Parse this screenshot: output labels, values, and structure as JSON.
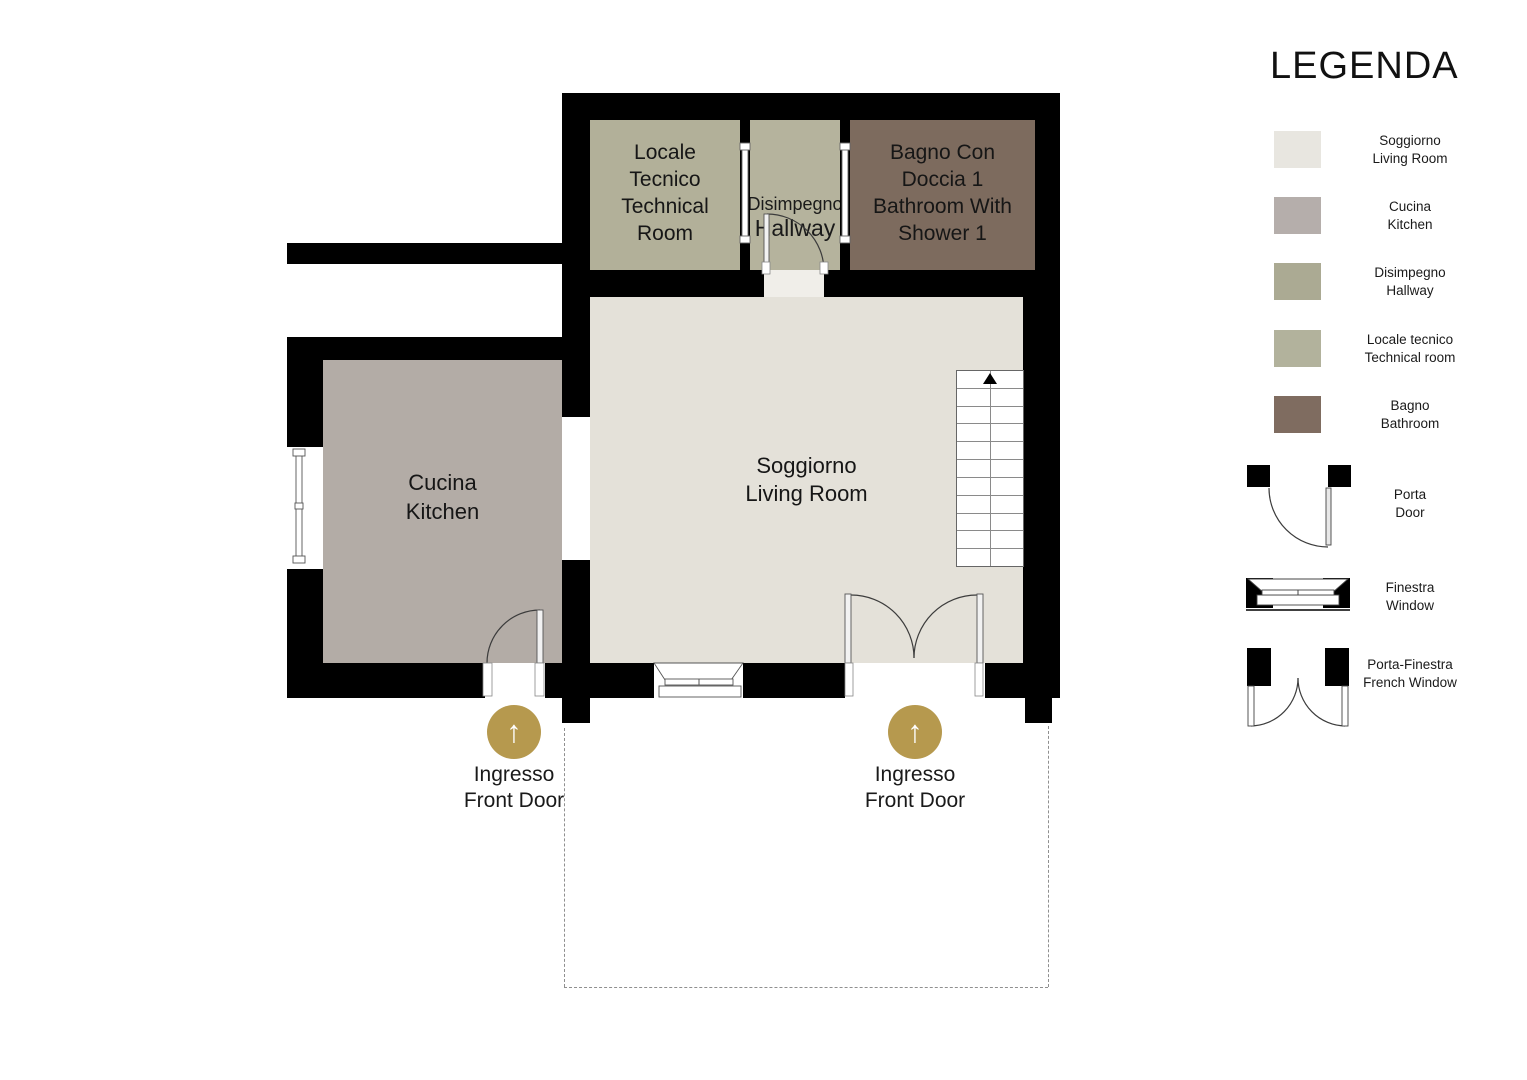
{
  "legend": {
    "title": "LEGENDA",
    "rooms": [
      {
        "it": "Soggiorno",
        "en": "Living Room",
        "label": "Soggiorno\nLiving Room",
        "color": "#e8e6e0"
      },
      {
        "it": "Cucina",
        "en": "Kitchen",
        "label": "Cucina\nKitchen",
        "color": "#b5aeab"
      },
      {
        "it": "Disimpegno",
        "en": "Hallway",
        "label": "Disimpegno\nHallway",
        "color": "#abaa93"
      },
      {
        "it": "Locale tecnico",
        "en": "Technical room",
        "label": "Locale tecnico\nTechnical room",
        "color": "#b2b29c"
      },
      {
        "it": "Bagno",
        "en": "Bathroom",
        "label": "Bagno\nBathroom",
        "color": "#7f6c60"
      }
    ],
    "symbols": [
      {
        "it": "Porta",
        "en": "Door",
        "label": "Porta\nDoor",
        "icon": "door-swing-icon"
      },
      {
        "it": "Finestra",
        "en": "Window",
        "label": "Finestra\nWindow",
        "icon": "window-icon"
      },
      {
        "it": "Porta-Finestra",
        "en": "French Window",
        "label": "Porta-Finestra\nFrench Window",
        "icon": "french-window-icon"
      }
    ]
  },
  "plan": {
    "rooms": {
      "technical": {
        "label": "Locale\nTecnico\nTechnical\nRoom",
        "color": "#b2b099"
      },
      "hallway": {
        "label_it": "Disimpegno",
        "label_en": "Hallway",
        "color": "#b5b39d"
      },
      "bathroom": {
        "label": "Bagno Con\nDoccia 1\nBathroom With\nShower 1",
        "color": "#7d6b5e"
      },
      "living": {
        "label": "Soggiorno\nLiving Room",
        "color": "#e4e1d9"
      },
      "kitchen": {
        "label": "Cucina\nKitchen",
        "color": "#b3aca6"
      }
    },
    "entrances": [
      {
        "label": "Ingresso\nFront Door"
      },
      {
        "label": "Ingresso\nFront Door"
      }
    ],
    "entrance_arrow_icon": "↑",
    "entrance_color": "#b6994e",
    "wall_color": "#000000",
    "stairs": {
      "steps": 11,
      "direction": "up"
    }
  }
}
